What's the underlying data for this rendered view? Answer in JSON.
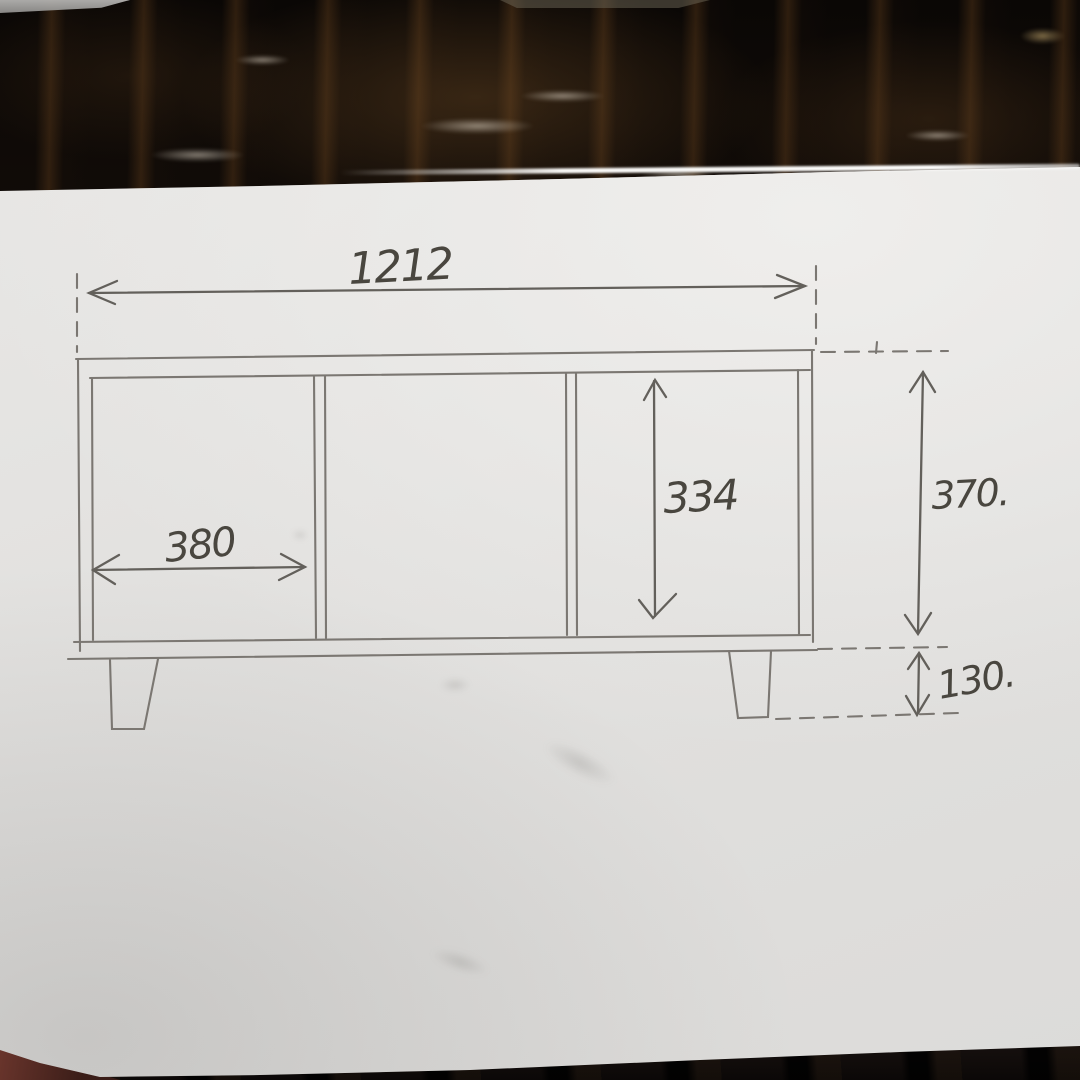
{
  "image": {
    "type": "photo-of-hand-drawn-sketch",
    "subject": "Pencil front-view drawing of a low three-compartment cabinet (TV board) with dimension arrows, on a white sheet of paper lying on a dark glossy wood table"
  },
  "sketch": {
    "object": "three-compartment low cabinet with two tapered legs",
    "compartment_count": 3,
    "leg_count": 2,
    "dimensions": {
      "overall_width": "1212",
      "left_compartment_width": "380",
      "opening_height": "334",
      "carcass_height": "370.",
      "leg_height": "130."
    },
    "colors": {
      "paper": "#e4e3e1",
      "pencil_line": "#7b7772",
      "handwriting": "#49463f",
      "table_wood_dark": "#140e09",
      "table_wood_light": "#6a4526",
      "table_edge_red": "#63332a"
    }
  }
}
